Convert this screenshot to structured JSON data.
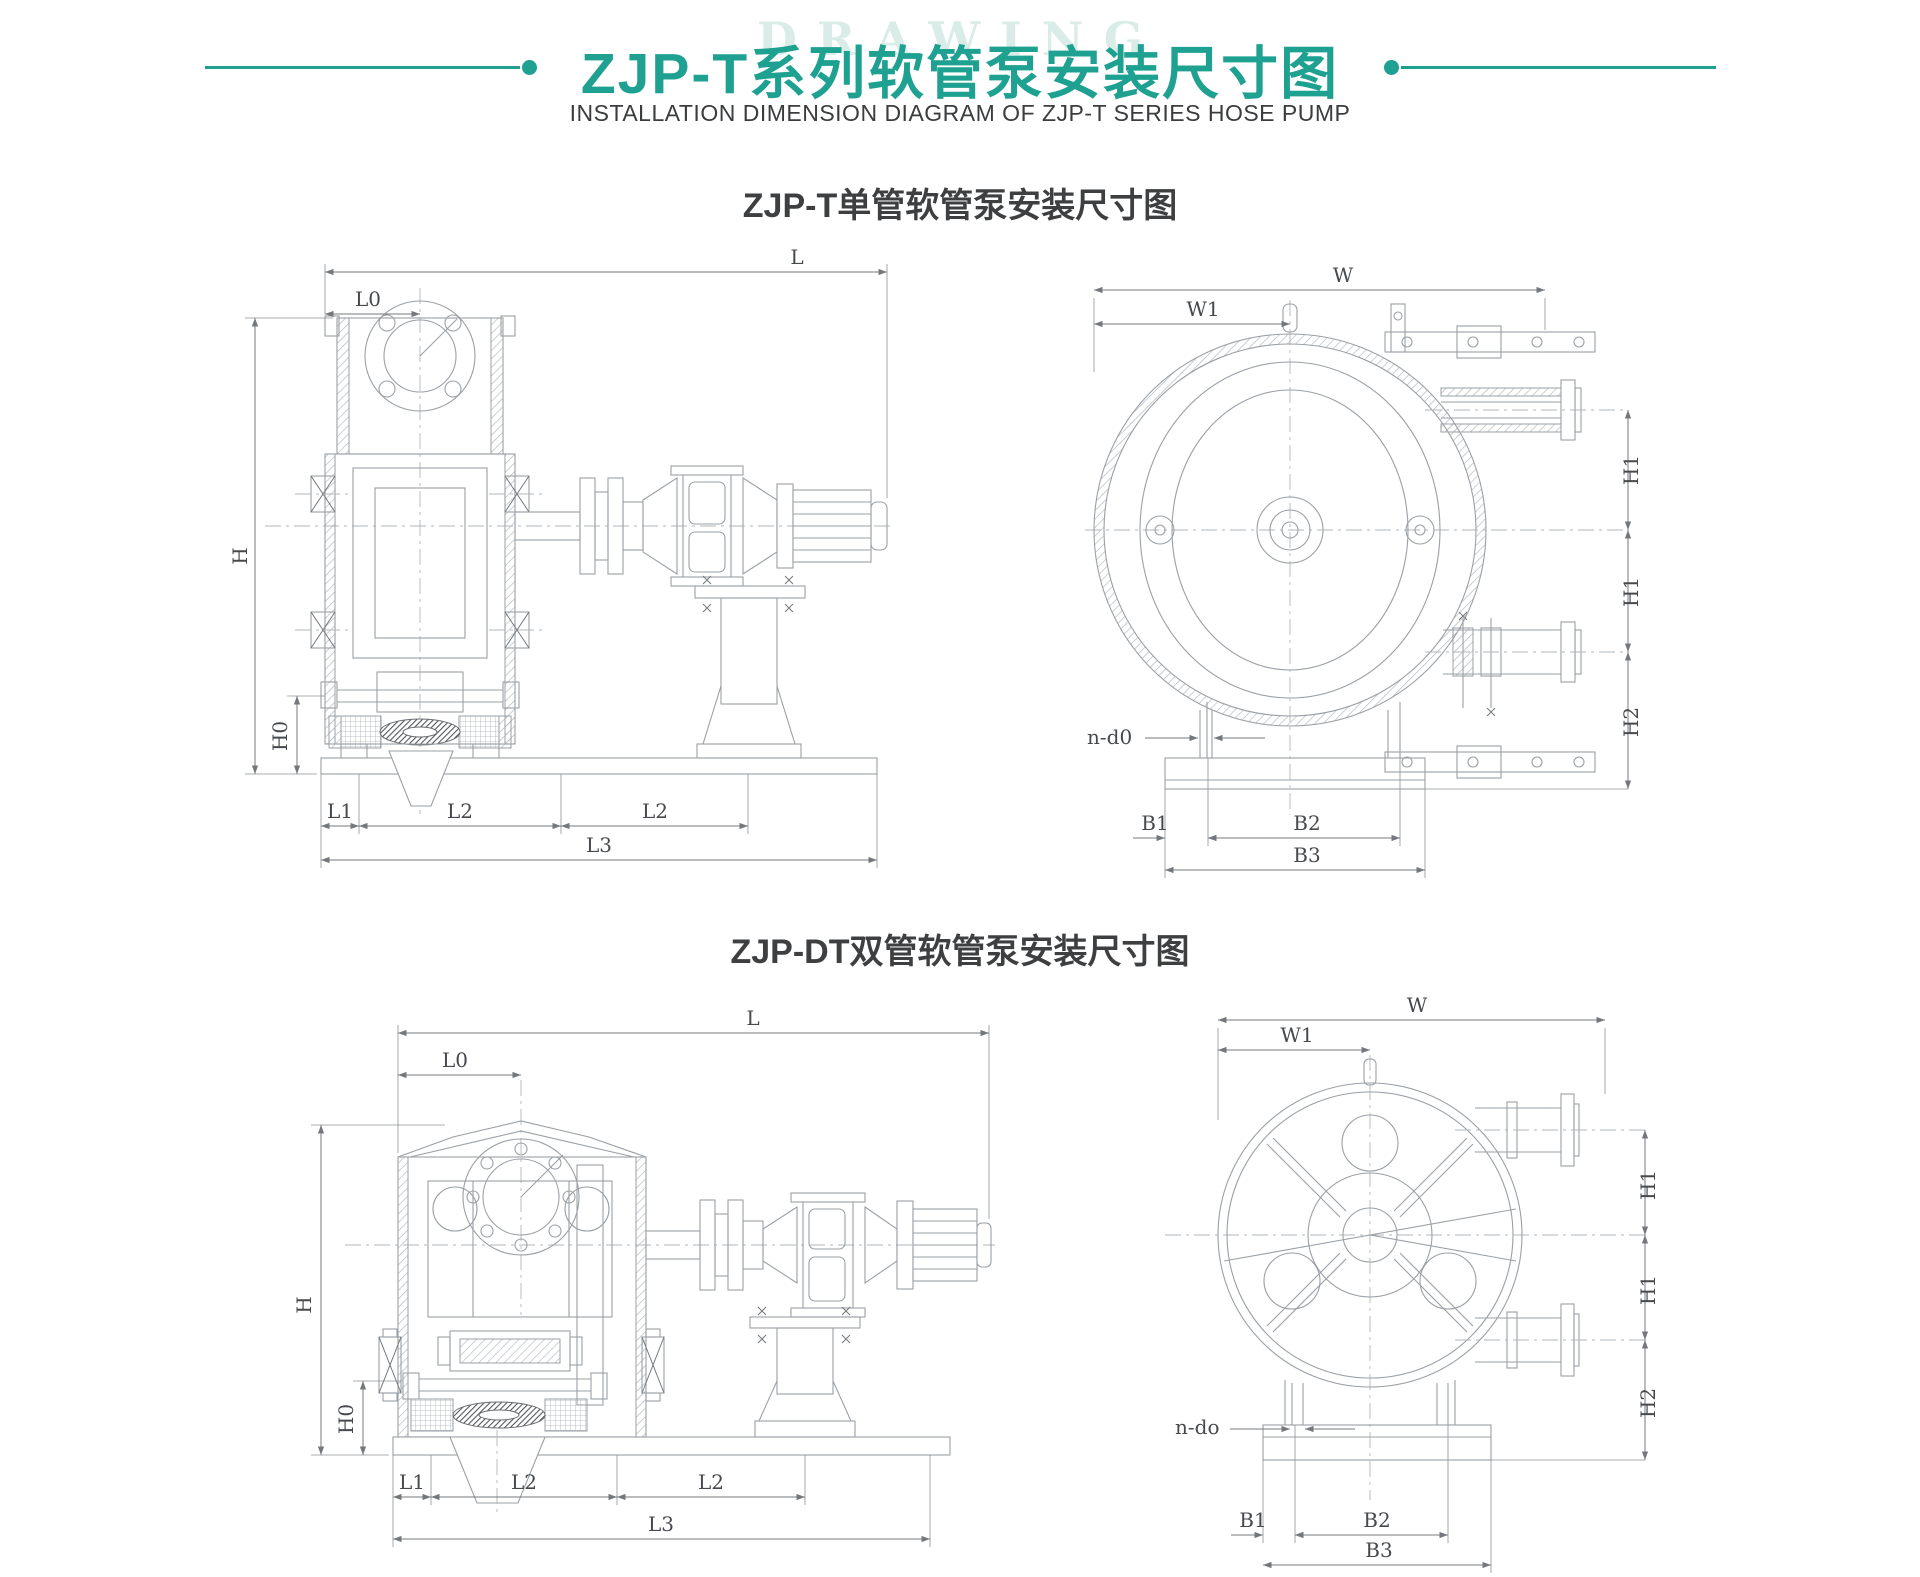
{
  "page": {
    "watermark": "DRAWING"
  },
  "header": {
    "title": "ZJP-T系列软管泵安装尺寸图",
    "subtitle": "INSTALLATION DIMENSION DIAGRAM OF ZJP-T SERIES HOSE PUMP"
  },
  "colors": {
    "accent": "#1fa191",
    "drawing_line": "#9aa0a6",
    "dim_text": "#46494d",
    "watermark": "#d9ece8",
    "heading_text": "#3d3f41"
  },
  "sections": {
    "single": {
      "title": "ZJP-T单管软管泵安装尺寸图"
    },
    "double": {
      "title": "ZJP-DT双管软管泵安装尺寸图"
    }
  },
  "drawings": {
    "single_side": {
      "labels": {
        "l": "L",
        "l0": "L0",
        "h": "H",
        "h0": "H0",
        "l1": "L1",
        "l2_a": "L2",
        "l2_b": "L2",
        "l3": "L3"
      }
    },
    "single_front": {
      "labels": {
        "w": "W",
        "w1": "W1",
        "h1_a": "H1",
        "h1_b": "H1",
        "h2": "H2",
        "bolt_note": "n-d0",
        "b1": "B1",
        "b2": "B2",
        "b3": "B3"
      }
    },
    "double_side": {
      "labels": {
        "l": "L",
        "l0": "L0",
        "h": "H",
        "h0": "H0",
        "l1": "L1",
        "l2_a": "L2",
        "l2_b": "L2",
        "l3": "L3"
      }
    },
    "double_front": {
      "labels": {
        "w": "W",
        "w1": "W1",
        "h1_a": "H1",
        "h1_b": "H1",
        "h2": "H2",
        "bolt_note": "n-do",
        "b1": "B1",
        "b2": "B2",
        "b3": "B3"
      }
    }
  }
}
